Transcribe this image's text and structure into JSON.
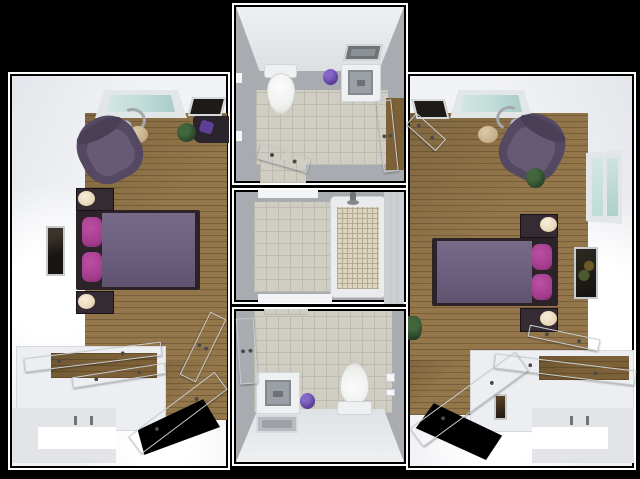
{
  "scene": {
    "title": "3D rendered floor plan: two mirrored bedrooms flanking a shared bathroom core",
    "background": "#000000",
    "palette": {
      "bg": "#000000",
      "outline": "#ffffff",
      "wall": "#f1f2f5",
      "wall_shade": "#dfe2e6",
      "bath_wall": "#a8abaf",
      "bath_wall_light": "#e9ebee",
      "wood": "#93764a",
      "wood_dark": "#7c6138",
      "tile": "#d0cdc3",
      "grout": "#bdbab0",
      "bed_frame": "#2b2328",
      "blanket": "#6e6180",
      "pillow": "#a23b8c",
      "armchair": "#544863",
      "armchair_light": "#665a75",
      "nightstand": "#352b32",
      "lamp": "#ead9bc",
      "glass": "#bfdcd8",
      "frame_metal": "#c7cbce",
      "plant": "#2e4a2c",
      "trash": "#5a3f96",
      "door": "#f3f4f6",
      "door_edge": "#c8ccd0",
      "tub": "#e9ebed",
      "mosaic": "#ddd5bf",
      "mosaic_grout": "#b3aa92",
      "sink": "#9aa0a5",
      "mat": "#b7babe",
      "fixture": "#eef0f2"
    },
    "rooms": {
      "left_bedroom": {
        "label": "Left bedroom",
        "furniture": {
          "window": {
            "label": "Window, top wall"
          },
          "wall_art": {
            "label": "Dark wall art / TV"
          },
          "desk": {
            "label": "Corner desk with purple chair"
          },
          "plant": {
            "label": "Potted plant"
          },
          "floor_lamp": {
            "label": "Arc floor lamp"
          },
          "ottoman": {
            "label": "Round ottoman"
          },
          "armchair": {
            "label": "Purple armchair"
          },
          "bed": {
            "label": "Bed, purple duvet, magenta pillows"
          },
          "nightstand_top": {
            "label": "Nightstand with lamp"
          },
          "nightstand_bottom": {
            "label": "Nightstand with lamp"
          },
          "wall_picture": {
            "label": "Framed picture, left wall"
          },
          "closet": {
            "label": "Closet with sliding doors ajar"
          },
          "entry_alcove": {
            "label": "Entry alcove wall"
          },
          "entry_door": {
            "label": "Entry door, open"
          },
          "bathroom_door": {
            "label": "Door to bathroom, open"
          }
        }
      },
      "top_bathroom": {
        "label": "Top bathroom",
        "furniture": {
          "mirror": {
            "label": "Wall mirror"
          },
          "toilet": {
            "label": "Toilet"
          },
          "vanity": {
            "label": "Vanity sink"
          },
          "trash_can": {
            "label": "Purple waste bin"
          },
          "bedroom_door": {
            "label": "Door to right bedroom, open"
          },
          "shower_door": {
            "label": "Door to tub room, open"
          }
        }
      },
      "tub_room": {
        "label": "Shared tub room",
        "furniture": {
          "bathtub": {
            "label": "Bathtub with tiled surround"
          },
          "faucet": {
            "label": "Tub faucet"
          }
        }
      },
      "bottom_bathroom": {
        "label": "Bottom bathroom",
        "furniture": {
          "vanity": {
            "label": "Vanity sink"
          },
          "trash_can": {
            "label": "Purple waste bin"
          },
          "toilet": {
            "label": "Toilet"
          },
          "bath_mat": {
            "label": "Bath mat"
          },
          "bedroom_door": {
            "label": "Door to left bedroom, open"
          },
          "paper_holder": {
            "label": "Toilet paper holder"
          }
        }
      },
      "right_bedroom": {
        "label": "Right bedroom",
        "furniture": {
          "window": {
            "label": "Window, top wall"
          },
          "wall_art": {
            "label": "Dark wall art / TV"
          },
          "floor_lamp": {
            "label": "Arc floor lamp"
          },
          "ottoman": {
            "label": "Round ottoman"
          },
          "armchair": {
            "label": "Purple armchair"
          },
          "plant_by_chair": {
            "label": "Potted plant by chair"
          },
          "side_window": {
            "label": "Window, right wall"
          },
          "bed": {
            "label": "Bed, purple duvet, magenta pillows"
          },
          "nightstand_top": {
            "label": "Nightstand with lamp"
          },
          "nightstand_bottom": {
            "label": "Nightstand with lamp"
          },
          "wall_picture": {
            "label": "Framed picture, right wall"
          },
          "floor_plant": {
            "label": "Plant at left wall"
          },
          "closet": {
            "label": "Closet with sliding doors ajar"
          },
          "closet_picture": {
            "label": "Small picture on closet wall"
          },
          "entry_alcove": {
            "label": "Entry alcove wall"
          },
          "entry_door": {
            "label": "Entry door, open"
          },
          "bathroom_door": {
            "label": "Door to bathroom, open"
          }
        }
      }
    }
  }
}
